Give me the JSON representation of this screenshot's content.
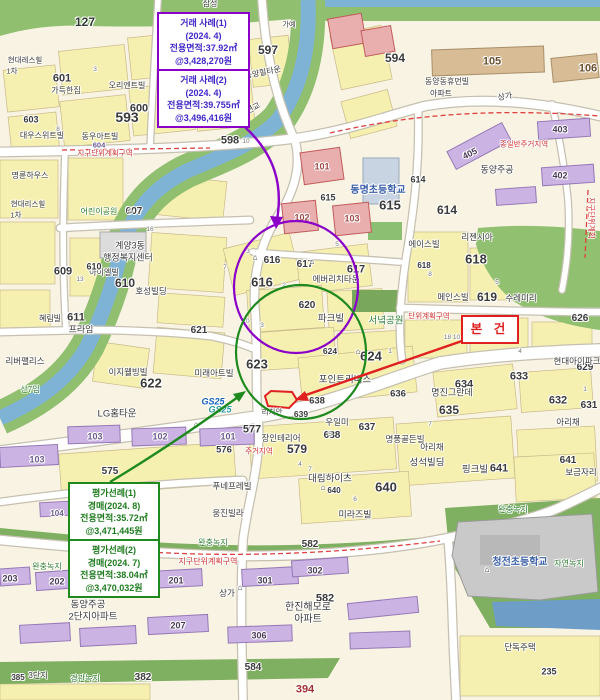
{
  "map": {
    "callouts": {
      "sale": {
        "border_color": "#8A00C8",
        "text_color": "#4326C8",
        "sections": [
          {
            "lines": [
              "거래 사례(1)",
              "(2024. 4)",
              "전용면적:37.92㎡",
              "@3,428,270원"
            ]
          },
          {
            "lines": [
              "거래 사례(2)",
              "(2024. 4)",
              "전용면적:39.755㎡",
              "@3,496,416원"
            ]
          }
        ]
      },
      "appraisal": {
        "border_color": "#1E8A1E",
        "text_color": "#1E7B1E",
        "sections": [
          {
            "lines": [
              "평가선례(1)",
              "경매(2024. 8)",
              "전용면적:35.72㎡",
              "@3,471,445원"
            ]
          },
          {
            "lines": [
              "평가선례(2)",
              "경매(2024. 7)",
              "전용면적:38.04㎡",
              "@3,470,032원"
            ]
          }
        ]
      },
      "subject": {
        "label": "본 건",
        "color": "#E02020"
      }
    },
    "legend_colors": {
      "parcel_yellow": "#F6F0B0",
      "road_white": "#FFFFFF",
      "park_green": "#8FBF6F",
      "water_blue": "#7FB3D5",
      "apartment_purple": "#CBB4E4",
      "condo_pink": "#E9AFAF",
      "school_gray": "#C9C9C9",
      "zone_red": "#D03030"
    },
    "labels": [
      {
        "t": "127",
        "x": 85,
        "y": 22,
        "s": 12,
        "b": 1,
        "c": "#2F3A2F"
      },
      {
        "t": "삼성",
        "x": 210,
        "y": 4,
        "s": 8
      },
      {
        "t": "가예",
        "x": 289,
        "y": 25,
        "s": 7
      },
      {
        "t": "594",
        "x": 395,
        "y": 58,
        "s": 12,
        "b": 1
      },
      {
        "t": "597",
        "x": 268,
        "y": 50,
        "s": 12,
        "b": 1
      },
      {
        "t": "593",
        "x": 127,
        "y": 117,
        "s": 14,
        "b": 1
      },
      {
        "t": "598",
        "x": 230,
        "y": 141,
        "s": 11,
        "b": 1
      },
      {
        "t": "601",
        "x": 62,
        "y": 79,
        "s": 11,
        "b": 1
      },
      {
        "t": "가득한집",
        "x": 66,
        "y": 91,
        "s": 8
      },
      {
        "t": "오리엔트빌",
        "x": 127,
        "y": 86,
        "s": 8
      },
      {
        "t": "600",
        "x": 139,
        "y": 109,
        "s": 11,
        "b": 1
      },
      {
        "t": "603",
        "x": 31,
        "y": 120,
        "s": 9,
        "b": 1
      },
      {
        "t": "현대레스힐",
        "x": 25,
        "y": 60,
        "s": 7.5
      },
      {
        "t": "1차",
        "x": 12,
        "y": 71,
        "s": 7.5
      },
      {
        "t": "대우스위트빌",
        "x": 42,
        "y": 136,
        "s": 8
      },
      {
        "t": "동우아트빌",
        "x": 100,
        "y": 137,
        "s": 8
      },
      {
        "t": "604",
        "x": 99,
        "y": 145,
        "s": 7.5,
        "b": 1,
        "c": "#6A5A8E"
      },
      {
        "t": "지구단위계획구역",
        "x": 105,
        "y": 153,
        "s": 7.5,
        "c": "#D03030"
      },
      {
        "t": "명륜하우스",
        "x": 30,
        "y": 176,
        "s": 8
      },
      {
        "t": "현대리스힐",
        "x": 28,
        "y": 204,
        "s": 7.5
      },
      {
        "t": "1차",
        "x": 16,
        "y": 215,
        "s": 7.5
      },
      {
        "t": "어린이공원",
        "x": 99,
        "y": 212,
        "s": 8,
        "c": "#2E7D32"
      },
      {
        "t": "607",
        "x": 134,
        "y": 212,
        "s": 10,
        "b": 1
      },
      {
        "t": "계양3동",
        "x": 130,
        "y": 246,
        "s": 9
      },
      {
        "t": "행정복지센터",
        "x": 128,
        "y": 258,
        "s": 9
      },
      {
        "t": "609",
        "x": 63,
        "y": 272,
        "s": 11,
        "b": 1
      },
      {
        "t": "아이엘빌",
        "x": 104,
        "y": 273,
        "s": 8
      },
      {
        "t": "610",
        "x": 94,
        "y": 267,
        "s": 9,
        "b": 1
      },
      {
        "t": "610",
        "x": 125,
        "y": 283,
        "s": 12,
        "b": 1
      },
      {
        "t": "호성빌딩",
        "x": 151,
        "y": 291,
        "s": 8.5
      },
      {
        "t": "611",
        "x": 76,
        "y": 318,
        "s": 11,
        "b": 1
      },
      {
        "t": "혜림빌",
        "x": 50,
        "y": 319,
        "s": 8
      },
      {
        "t": "프라임",
        "x": 81,
        "y": 330,
        "s": 9
      },
      {
        "t": "리버팰리스",
        "x": 25,
        "y": 361,
        "s": 8.5
      },
      {
        "t": "산7임",
        "x": 30,
        "y": 390,
        "s": 8,
        "c": "#2E7D32"
      },
      {
        "t": "양지편교",
        "x": 247,
        "y": 112,
        "s": 8,
        "r": -28
      },
      {
        "t": "동양힐타운",
        "x": 263,
        "y": 73,
        "s": 8,
        "r": -12
      },
      {
        "t": "105",
        "x": 492,
        "y": 62,
        "s": 11,
        "b": 1,
        "c": "#6B4E2E"
      },
      {
        "t": "106",
        "x": 588,
        "y": 69,
        "s": 11,
        "b": 1,
        "c": "#6B4E2E"
      },
      {
        "t": "상가",
        "x": 505,
        "y": 97,
        "s": 8,
        "r": -10
      },
      {
        "t": "동양동휴먼빌",
        "x": 447,
        "y": 82,
        "s": 8
      },
      {
        "t": "아파트",
        "x": 441,
        "y": 94,
        "s": 8
      },
      {
        "t": "종일반주거지역",
        "x": 524,
        "y": 144,
        "s": 7.5,
        "c": "#D03030"
      },
      {
        "t": "403",
        "x": 560,
        "y": 130,
        "s": 9,
        "b": 1,
        "c": "#4A3A5A"
      },
      {
        "t": "405",
        "x": 470,
        "y": 154,
        "s": 9,
        "b": 1,
        "c": "#4A3A5A",
        "r": -26
      },
      {
        "t": "402",
        "x": 560,
        "y": 176,
        "s": 9,
        "b": 1,
        "c": "#4A3A5A"
      },
      {
        "t": "동양주공",
        "x": 497,
        "y": 170,
        "s": 9
      },
      {
        "t": "지구단위계획",
        "x": 591,
        "y": 218,
        "s": 7.5,
        "c": "#D03030",
        "r": 90
      },
      {
        "t": "101",
        "x": 322,
        "y": 167,
        "s": 9,
        "b": 1,
        "c": "#A04848"
      },
      {
        "t": "102",
        "x": 302,
        "y": 218,
        "s": 9,
        "b": 1,
        "c": "#A04848"
      },
      {
        "t": "103",
        "x": 352,
        "y": 219,
        "s": 9,
        "b": 1,
        "c": "#A04848"
      },
      {
        "t": "615",
        "x": 328,
        "y": 198,
        "s": 9,
        "b": 1
      },
      {
        "t": "615",
        "x": 390,
        "y": 205,
        "s": 13,
        "b": 1
      },
      {
        "t": "동명초등학교",
        "x": 378,
        "y": 191,
        "s": 10,
        "b": 1,
        "c": "#3A5FA8"
      },
      {
        "t": "614",
        "x": 418,
        "y": 180,
        "s": 9,
        "b": 1
      },
      {
        "t": "614",
        "x": 447,
        "y": 210,
        "s": 12,
        "b": 1
      },
      {
        "t": "에이스빌",
        "x": 424,
        "y": 244,
        "s": 8.5
      },
      {
        "t": "리젠시아",
        "x": 477,
        "y": 237,
        "s": 8.5
      },
      {
        "t": "618",
        "x": 476,
        "y": 259,
        "s": 13,
        "b": 1
      },
      {
        "t": "618",
        "x": 424,
        "y": 266,
        "s": 8,
        "b": 1
      },
      {
        "t": "619",
        "x": 487,
        "y": 297,
        "s": 12,
        "b": 1
      },
      {
        "t": "메인스빌",
        "x": 453,
        "y": 297,
        "s": 8.5
      },
      {
        "t": "수레미리",
        "x": 521,
        "y": 298,
        "s": 8.5
      },
      {
        "t": "616",
        "x": 272,
        "y": 261,
        "s": 10,
        "b": 1
      },
      {
        "t": "616",
        "x": 262,
        "y": 282,
        "s": 13,
        "b": 1
      },
      {
        "t": "617",
        "x": 305,
        "y": 265,
        "s": 10,
        "b": 1
      },
      {
        "t": "617",
        "x": 356,
        "y": 270,
        "s": 11,
        "b": 1
      },
      {
        "t": "에버리치타운",
        "x": 336,
        "y": 279,
        "s": 8.5
      },
      {
        "t": "620",
        "x": 307,
        "y": 306,
        "s": 10,
        "b": 1
      },
      {
        "t": "파크빌",
        "x": 331,
        "y": 319,
        "s": 9.5
      },
      {
        "t": "621",
        "x": 199,
        "y": 331,
        "s": 10,
        "b": 1
      },
      {
        "t": "서녘공원",
        "x": 386,
        "y": 321,
        "s": 9.5,
        "c": "#2E7D32"
      },
      {
        "t": "626",
        "x": 580,
        "y": 319,
        "s": 10,
        "b": 1
      },
      {
        "t": "629",
        "x": 585,
        "y": 368,
        "s": 10,
        "b": 1
      },
      {
        "t": "단위계획구역",
        "x": 429,
        "y": 316,
        "s": 7.5,
        "c": "#D03030"
      },
      {
        "t": "623",
        "x": 257,
        "y": 364,
        "s": 13,
        "b": 1
      },
      {
        "t": "624",
        "x": 371,
        "y": 356,
        "s": 13,
        "b": 1
      },
      {
        "t": "624",
        "x": 330,
        "y": 351,
        "s": 8.5,
        "b": 1
      },
      {
        "t": "이지웰빙빌",
        "x": 128,
        "y": 372,
        "s": 8.5
      },
      {
        "t": "622",
        "x": 151,
        "y": 383,
        "s": 13,
        "b": 1
      },
      {
        "t": "미래아트빌",
        "x": 214,
        "y": 373,
        "s": 8.5
      },
      {
        "t": "LG홈타운",
        "x": 117,
        "y": 414,
        "s": 9.5
      },
      {
        "t": "GS25",
        "x": 213,
        "y": 402,
        "s": 9,
        "b": 1,
        "c": "#1560BD",
        "i": 1
      },
      {
        "t": "GS25",
        "x": 220,
        "y": 410,
        "s": 9,
        "b": 1,
        "c": "#2A9AA0",
        "i": 1
      },
      {
        "t": "포인트리버스",
        "x": 345,
        "y": 380,
        "s": 9.5
      },
      {
        "t": "리치안",
        "x": 272,
        "y": 412,
        "s": 7.5
      },
      {
        "t": "639",
        "x": 301,
        "y": 414,
        "s": 8.5,
        "b": 1
      },
      {
        "t": "638",
        "x": 317,
        "y": 401,
        "s": 9.5,
        "b": 1
      },
      {
        "t": "우일미",
        "x": 337,
        "y": 422,
        "s": 8.5
      },
      {
        "t": "577",
        "x": 252,
        "y": 430,
        "s": 11,
        "b": 1
      },
      {
        "t": "장인테리어",
        "x": 281,
        "y": 438,
        "s": 8.5
      },
      {
        "t": "579",
        "x": 297,
        "y": 449,
        "s": 12,
        "b": 1
      },
      {
        "t": "주거지역",
        "x": 259,
        "y": 451,
        "s": 7.5,
        "c": "#D03030"
      },
      {
        "t": "576",
        "x": 224,
        "y": 450,
        "s": 9.5,
        "b": 1
      },
      {
        "t": "575",
        "x": 110,
        "y": 472,
        "s": 10,
        "b": 1
      },
      {
        "t": "103",
        "x": 95,
        "y": 437,
        "s": 9,
        "b": 1,
        "c": "#6A5A8E"
      },
      {
        "t": "102",
        "x": 160,
        "y": 437,
        "s": 9,
        "b": 1,
        "c": "#6A5A8E"
      },
      {
        "t": "101",
        "x": 228,
        "y": 437,
        "s": 9,
        "b": 1,
        "c": "#6A5A8E"
      },
      {
        "t": "103",
        "x": 37,
        "y": 460,
        "s": 9,
        "b": 1,
        "c": "#6A5A8E"
      },
      {
        "t": "104",
        "x": 57,
        "y": 514,
        "s": 8,
        "b": 1,
        "c": "#6A5A8E"
      },
      {
        "t": "637",
        "x": 367,
        "y": 428,
        "s": 10,
        "b": 1
      },
      {
        "t": "638",
        "x": 332,
        "y": 436,
        "s": 10,
        "b": 1
      },
      {
        "t": "명풍골든빌",
        "x": 405,
        "y": 439,
        "s": 8.5
      },
      {
        "t": "633",
        "x": 519,
        "y": 377,
        "s": 11,
        "b": 1
      },
      {
        "t": "634",
        "x": 464,
        "y": 385,
        "s": 11,
        "b": 1
      },
      {
        "t": "635",
        "x": 449,
        "y": 410,
        "s": 12,
        "b": 1
      },
      {
        "t": "632",
        "x": 558,
        "y": 401,
        "s": 11,
        "b": 1
      },
      {
        "t": "631",
        "x": 589,
        "y": 406,
        "s": 10,
        "b": 1
      },
      {
        "t": "아리채",
        "x": 432,
        "y": 447,
        "s": 8.5
      },
      {
        "t": "아리채",
        "x": 568,
        "y": 422,
        "s": 8.5
      },
      {
        "t": "현대아이파크",
        "x": 577,
        "y": 361,
        "s": 8.5
      },
      {
        "t": "명진그란데",
        "x": 452,
        "y": 393,
        "s": 9
      },
      {
        "t": "636",
        "x": 398,
        "y": 394,
        "s": 9.5,
        "b": 1
      },
      {
        "t": "성석빌딩",
        "x": 427,
        "y": 463,
        "s": 9.5
      },
      {
        "t": "대림하이츠",
        "x": 330,
        "y": 479,
        "s": 9.5
      },
      {
        "t": "640",
        "x": 386,
        "y": 487,
        "s": 13,
        "b": 1
      },
      {
        "t": "640",
        "x": 334,
        "y": 491,
        "s": 8,
        "b": 1
      },
      {
        "t": "핑크빌",
        "x": 475,
        "y": 470,
        "s": 9.5
      },
      {
        "t": "641",
        "x": 499,
        "y": 469,
        "s": 11,
        "b": 1
      },
      {
        "t": "641",
        "x": 568,
        "y": 461,
        "s": 10,
        "b": 1
      },
      {
        "t": "보금자리",
        "x": 581,
        "y": 472,
        "s": 8.5
      },
      {
        "t": "미라즈빌",
        "x": 355,
        "y": 515,
        "s": 9
      },
      {
        "t": "웅진빌라",
        "x": 228,
        "y": 513,
        "s": 8.5
      },
      {
        "t": "푸네프레빌",
        "x": 232,
        "y": 486,
        "s": 8.5
      },
      {
        "t": "완충녹지",
        "x": 513,
        "y": 510,
        "s": 8,
        "c": "#2E7D32"
      },
      {
        "t": "청전초등학교",
        "x": 520,
        "y": 563,
        "s": 10,
        "b": 1,
        "c": "#3A5FA8"
      },
      {
        "t": "자연녹지",
        "x": 569,
        "y": 564,
        "s": 8,
        "c": "#2E7D32"
      },
      {
        "t": "완충녹지",
        "x": 213,
        "y": 543,
        "s": 8,
        "c": "#2E7D32"
      },
      {
        "t": "582",
        "x": 310,
        "y": 545,
        "s": 10,
        "b": 1
      },
      {
        "t": "지구단위계획구역",
        "x": 208,
        "y": 562,
        "s": 8,
        "c": "#D03030"
      },
      {
        "t": "201",
        "x": 176,
        "y": 581,
        "s": 9,
        "b": 1,
        "c": "#4A3A5A"
      },
      {
        "t": "301",
        "x": 265,
        "y": 581,
        "s": 9,
        "b": 1,
        "c": "#4A3A5A"
      },
      {
        "t": "302",
        "x": 315,
        "y": 571,
        "s": 9,
        "b": 1,
        "c": "#4A3A5A"
      },
      {
        "t": "582",
        "x": 325,
        "y": 599,
        "s": 11,
        "b": 1
      },
      {
        "t": "한진해모로",
        "x": 308,
        "y": 608,
        "s": 10
      },
      {
        "t": "아파트",
        "x": 308,
        "y": 620,
        "s": 10
      },
      {
        "t": "207",
        "x": 178,
        "y": 626,
        "s": 9,
        "b": 1,
        "c": "#4A3A5A"
      },
      {
        "t": "306",
        "x": 259,
        "y": 636,
        "s": 9,
        "b": 1,
        "c": "#4A3A5A"
      },
      {
        "t": "상가",
        "x": 227,
        "y": 593,
        "s": 8.5
      },
      {
        "t": "203",
        "x": 10,
        "y": 579,
        "s": 9,
        "b": 1,
        "c": "#4A3A5A"
      },
      {
        "t": "202",
        "x": 57,
        "y": 582,
        "s": 9,
        "b": 1,
        "c": "#4A3A5A"
      },
      {
        "t": "완충녹지",
        "x": 47,
        "y": 567,
        "s": 8,
        "c": "#2E7D32"
      },
      {
        "t": "동양주공",
        "x": 88,
        "y": 605,
        "s": 9.5
      },
      {
        "t": "2단지아파트",
        "x": 93,
        "y": 617,
        "s": 9.5
      },
      {
        "t": "385",
        "x": 18,
        "y": 678,
        "s": 8,
        "b": 1
      },
      {
        "t": "382",
        "x": 143,
        "y": 678,
        "s": 10,
        "b": 1
      },
      {
        "t": "경관녹지",
        "x": 85,
        "y": 679,
        "s": 8,
        "c": "#2E7D32"
      },
      {
        "t": "584",
        "x": 253,
        "y": 668,
        "s": 10,
        "b": 1
      },
      {
        "t": "394",
        "x": 305,
        "y": 690,
        "s": 11,
        "b": 1,
        "c": "#A03030"
      },
      {
        "t": "단독주택",
        "x": 520,
        "y": 647,
        "s": 8.5
      },
      {
        "t": "235",
        "x": 549,
        "y": 672,
        "s": 9,
        "b": 1
      },
      {
        "t": "3단지",
        "x": 38,
        "y": 676,
        "s": 8
      },
      {
        "t": "⌂",
        "x": 255,
        "y": 258,
        "s": 8,
        "b": 1
      },
      {
        "t": "⌂",
        "x": 312,
        "y": 262,
        "s": 8,
        "b": 1
      },
      {
        "t": "⌂",
        "x": 358,
        "y": 352,
        "s": 8,
        "b": 1
      },
      {
        "t": "⌂",
        "x": 196,
        "y": 425,
        "s": 8,
        "b": 1
      },
      {
        "t": "⌂",
        "x": 323,
        "y": 488,
        "s": 8,
        "b": 1
      },
      {
        "t": "⌂",
        "x": 487,
        "y": 570,
        "s": 8,
        "b": 1
      },
      {
        "t": "⌂",
        "x": 240,
        "y": 588,
        "s": 8,
        "b": 1
      },
      {
        "t": "⌂",
        "x": 130,
        "y": 211,
        "s": 8,
        "b": 1
      }
    ],
    "lot_numbers": [
      {
        "t": "7",
        "x": 172,
        "y": 57
      },
      {
        "t": "3",
        "x": 95,
        "y": 70
      },
      {
        "t": "4",
        "x": 210,
        "y": 125
      },
      {
        "t": "8",
        "x": 58,
        "y": 130
      },
      {
        "t": "10",
        "x": 246,
        "y": 142
      },
      {
        "t": "16",
        "x": 150,
        "y": 230
      },
      {
        "t": "7",
        "x": 225,
        "y": 268
      },
      {
        "t": "2",
        "x": 284,
        "y": 286
      },
      {
        "t": "5",
        "x": 337,
        "y": 245
      },
      {
        "t": "3",
        "x": 248,
        "y": 252
      },
      {
        "t": "10",
        "x": 246,
        "y": 322
      },
      {
        "t": "3",
        "x": 262,
        "y": 326
      },
      {
        "t": "18 10",
        "x": 452,
        "y": 338
      },
      {
        "t": "1",
        "x": 390,
        "y": 352
      },
      {
        "t": "4",
        "x": 520,
        "y": 352
      },
      {
        "t": "5",
        "x": 330,
        "y": 435
      },
      {
        "t": "7",
        "x": 310,
        "y": 470
      },
      {
        "t": "6",
        "x": 355,
        "y": 500
      },
      {
        "t": "1",
        "x": 585,
        "y": 390
      },
      {
        "t": "7",
        "x": 430,
        "y": 425
      },
      {
        "t": "13",
        "x": 80,
        "y": 280
      },
      {
        "t": "8",
        "x": 430,
        "y": 275
      },
      {
        "t": "5",
        "x": 497,
        "y": 283
      },
      {
        "t": "4",
        "x": 300,
        "y": 465
      }
    ]
  }
}
